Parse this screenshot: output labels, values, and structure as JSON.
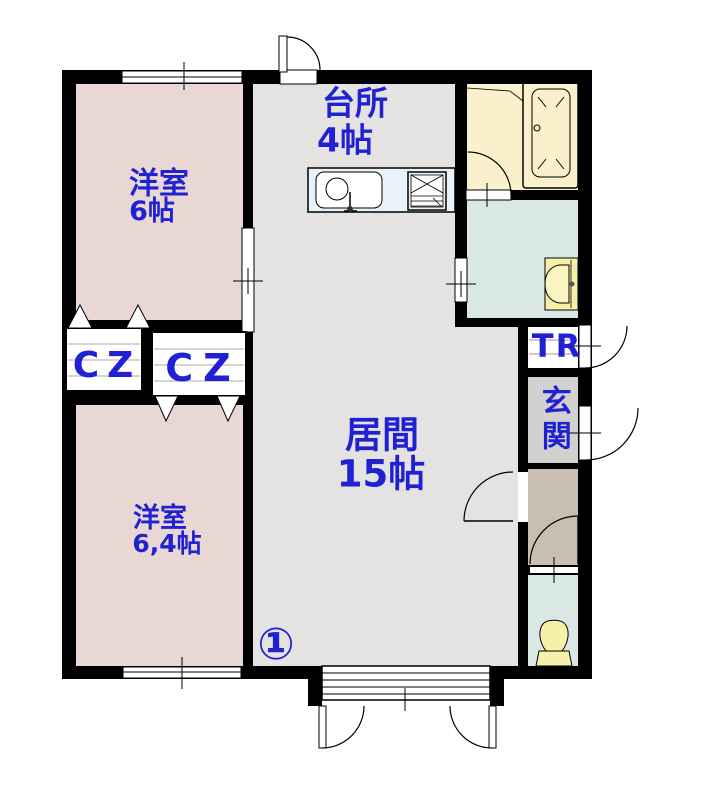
{
  "plan_title": "apartment-floor-plan",
  "rooms": {
    "bedroom1": {
      "name": "洋室",
      "size": "6帖"
    },
    "kitchen": {
      "name": "台所",
      "size": "4帖"
    },
    "living": {
      "name": "居間",
      "size": "15帖"
    },
    "bedroom2": {
      "name": "洋室",
      "size": "6,4帖"
    },
    "entrance": {
      "name": "玄関"
    },
    "trunk_room": {
      "name": "TR"
    },
    "closet_left": {
      "name": "CZ"
    },
    "closet_right": {
      "name": "CZ"
    }
  },
  "unit_number": "①",
  "colors": {
    "wall": "#000000",
    "bedroom_floor": "#e8d7d3",
    "living_floor": "#e5e2e2",
    "bathroom_floor": "#faf0cc",
    "sanitary_floor": "#d9e7e5",
    "entrance_floor": "#d3d1cf",
    "hall_floor": "#c9beb2",
    "counter": "#e7f3f8",
    "fixture_yellow": "#f7f0a8",
    "label_blue": "#2121d4"
  }
}
